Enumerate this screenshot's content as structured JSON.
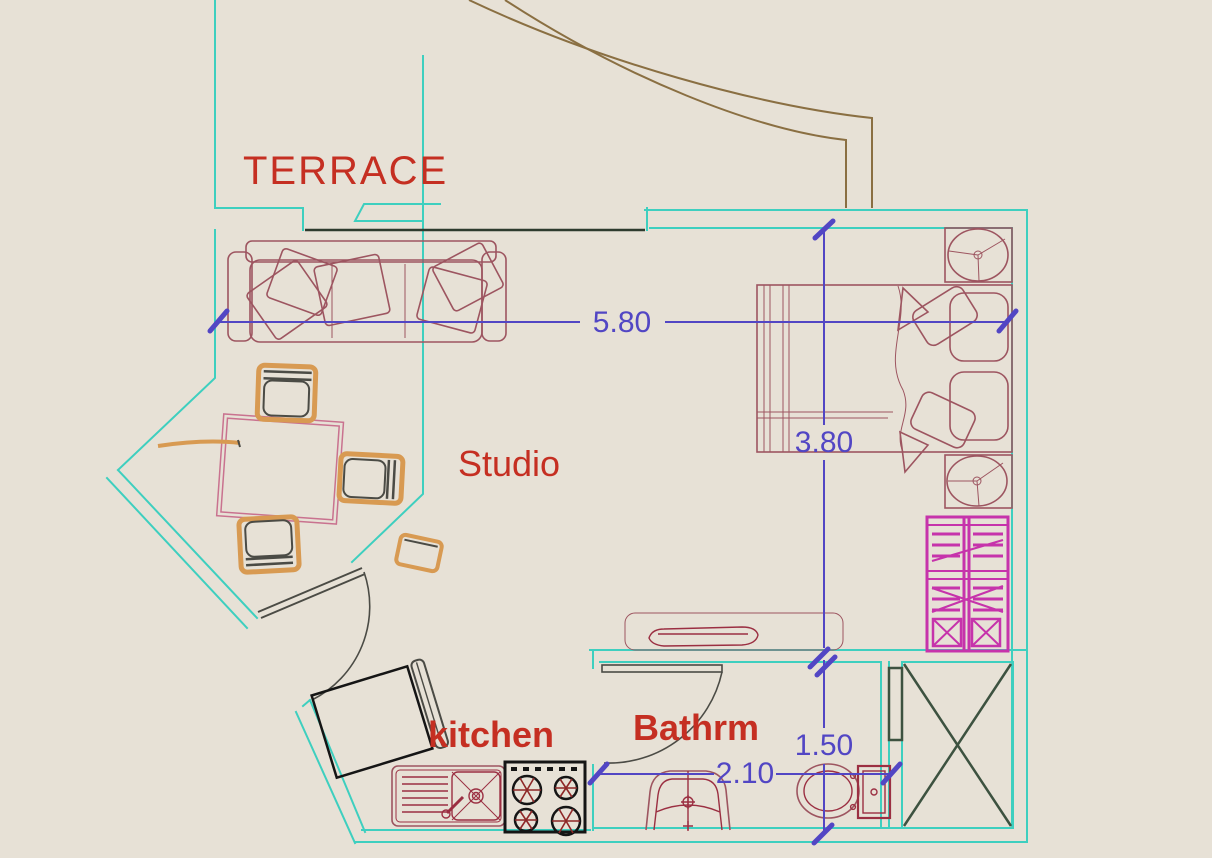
{
  "plan": {
    "labels": {
      "terrace": "TERRACE",
      "studio": "Studio",
      "kitchen": "kitchen",
      "bathroom": "Bathrm"
    },
    "dimensions": {
      "studio_width": "5.80",
      "studio_depth": "3.80",
      "bathroom_depth": "1.50",
      "bathroom_width": "2.10"
    }
  },
  "colors": {
    "paper": "#e7e1d6",
    "wall": "#3ecfbf",
    "label_red": "#c52f22",
    "dimension_blue": "#5246c4",
    "furniture_maroon": "#9d5560",
    "fixture_dark_red": "#9b2f42",
    "table_pink": "#c9728f",
    "wood_tan": "#d89a52",
    "dark_gray": "#4b4b45",
    "terrace_brown": "#8a6f42",
    "wardrobe_magenta": "#c633ab",
    "appliance_black": "#151515",
    "burner_red": "#8e2727",
    "duct_green": "#3d5240",
    "window_dark": "#2e3b2e"
  },
  "furniture": [
    "sofa-with-cushions",
    "dining-table",
    "dining-chair",
    "stool",
    "bed",
    "pillow",
    "headboard-cushion",
    "nightstand-lamp",
    "wardrobe",
    "console-table",
    "entrance-door",
    "bathroom-door",
    "terrace-door",
    "bidet",
    "toilet",
    "fridge",
    "kitchen-sink",
    "stove",
    "service-shaft",
    "terrace-edge"
  ]
}
